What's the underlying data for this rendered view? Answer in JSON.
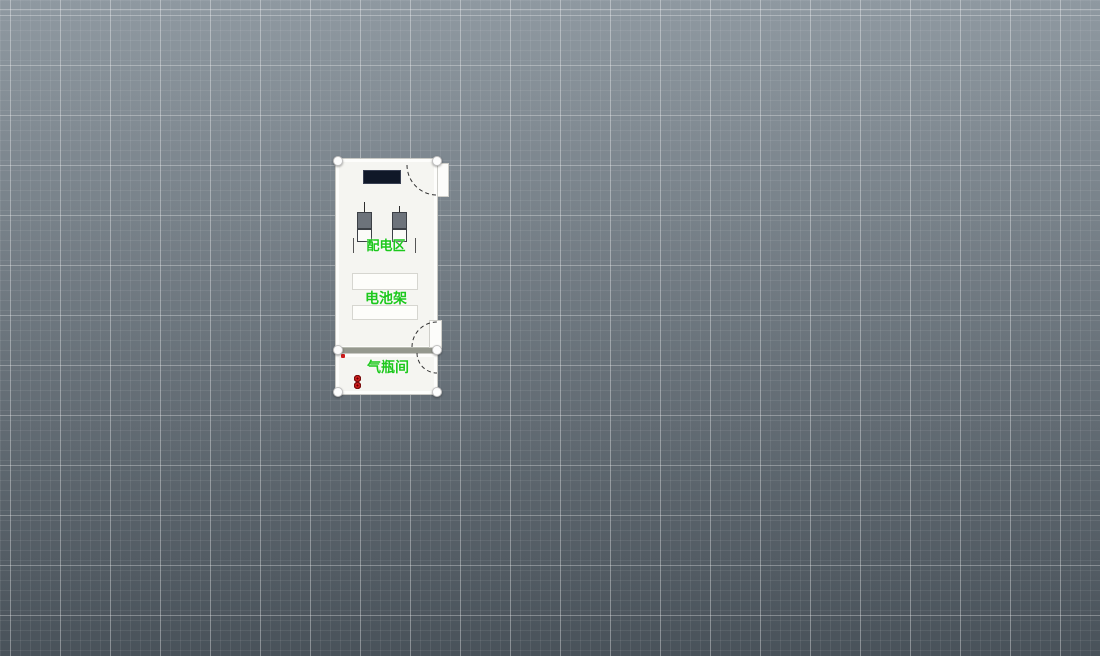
{
  "canvas": {
    "bg_top": "#8f99a1",
    "bg_bottom": "#49525a",
    "grid_major_spacing": 50,
    "grid_minor_spacing": 10
  },
  "labels": {
    "distribution_area": "配电区",
    "battery_rack": "电池架",
    "gas_room": "气瓶间"
  },
  "colors": {
    "label_green": "#1dc81d",
    "cylinder_red": "#cf1d1d",
    "cylinder_core": "#600000",
    "wall_gray": "#95988e",
    "console_navy": "#101828",
    "cabinet_gray": "#6d737b",
    "room_fill": "#f5f5f1"
  },
  "equipment": {
    "power_cabinets": 2,
    "battery_racks": 2,
    "doors": 2,
    "selection_handles": 6,
    "cylinder_column_count": 8,
    "cylinder_rows": [
      {
        "count": 8,
        "gap_after": 5
      },
      {
        "count": 9,
        "gap_after": 5
      }
    ]
  }
}
